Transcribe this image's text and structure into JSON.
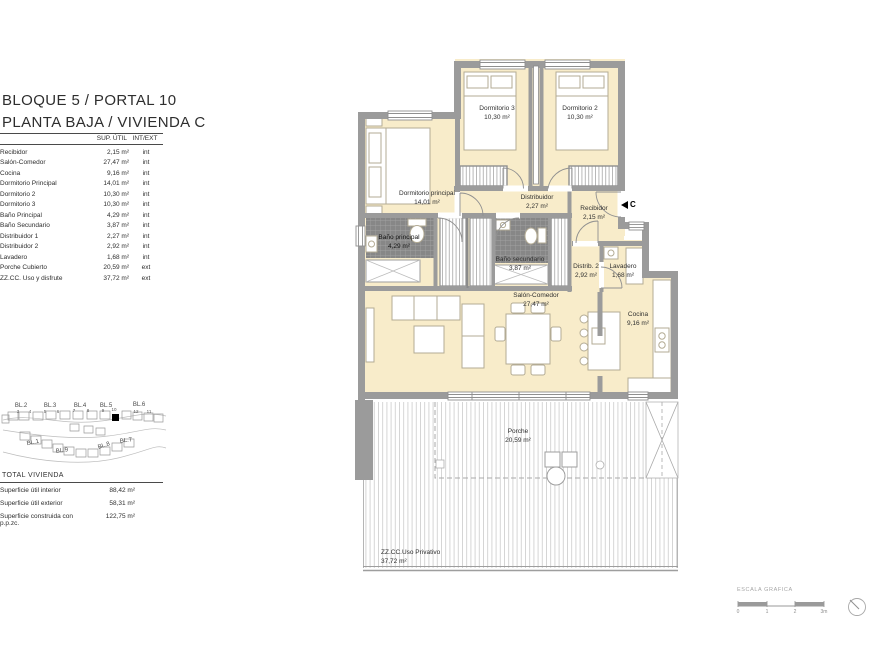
{
  "header": {
    "line1": "BLOQUE 5 / PORTAL 10",
    "line2": "PLANTA BAJA / VIVIENDA C"
  },
  "area_table": {
    "col_sup": "SUP.  ÚTIL",
    "col_intext": "INT/EXT",
    "rows": [
      {
        "label": "Recibidor",
        "value": "2,15 m²",
        "type": "int"
      },
      {
        "label": "Salón-Comedor",
        "value": "27,47 m²",
        "type": "int"
      },
      {
        "label": "Cocina",
        "value": "9,16 m²",
        "type": "int"
      },
      {
        "label": "Dormitorio Principal",
        "value": "14,01 m²",
        "type": "int"
      },
      {
        "label": "Dormitorio 2",
        "value": "10,30 m²",
        "type": "int"
      },
      {
        "label": "Dormitorio 3",
        "value": "10,30 m²",
        "type": "int"
      },
      {
        "label": "Baño Principal",
        "value": "4,29 m²",
        "type": "int"
      },
      {
        "label": "Baño Secundario",
        "value": "3,87 m²",
        "type": "int"
      },
      {
        "label": "Distribuidor 1",
        "value": "2,27 m²",
        "type": "int"
      },
      {
        "label": "Distribuidor 2",
        "value": "2,92 m²",
        "type": "int"
      },
      {
        "label": "Lavadero",
        "value": "1,68 m²",
        "type": "int"
      },
      {
        "label": "Porche Cubierto",
        "value": "20,59 m²",
        "type": "ext"
      },
      {
        "label": "ZZ.CC. Uso y disfrute",
        "value": "37,72 m²",
        "type": "ext"
      }
    ]
  },
  "totals": {
    "title": "TOTAL VIVIENDA",
    "rows": [
      {
        "label": "Superficie útil interior",
        "value": "88,42 m²"
      },
      {
        "label": "Superficie útil exterior",
        "value": "58,31 m²"
      },
      {
        "label": "Superficie construida con p.p.zc.",
        "value": "122,75 m²"
      }
    ]
  },
  "site_plan": {
    "blocks": [
      "BL.2",
      "BL.3",
      "BL.4",
      "BL.5",
      "BL.6",
      "BL.1",
      "BL.9",
      "BL.8",
      "BL.7"
    ],
    "numbers": [
      "3",
      "4",
      "5",
      "6",
      "7",
      "8",
      "9",
      "10",
      "12",
      "11"
    ]
  },
  "plan": {
    "entry_marker": "C",
    "rooms": [
      {
        "name": "Dormitorio 3",
        "area": "10,30 m²"
      },
      {
        "name": "Dormitorio 2",
        "area": "10,30 m²"
      },
      {
        "name": "Dormitorio principal",
        "area": "14,01 m²"
      },
      {
        "name": "Distribuidor",
        "area": "2,27 m²"
      },
      {
        "name": "Recibidor",
        "area": "2,15 m²"
      },
      {
        "name": "Baño principal",
        "area": "4,29 m²"
      },
      {
        "name": "Baño secundario",
        "area": "3,87 m²"
      },
      {
        "name": "Distrib. 2",
        "area": "2,92 m²"
      },
      {
        "name": "Lavadero",
        "area": "1,68 m²"
      },
      {
        "name": "Salón-Comedor",
        "area": "27,47 m²"
      },
      {
        "name": "Cocina",
        "area": "9,16 m²"
      },
      {
        "name": "Porche",
        "area": "20,59 m²"
      },
      {
        "name": "ZZ.CC.Uso Privativo",
        "area": "37,72 m²"
      }
    ]
  },
  "scale_bar": {
    "title": "ESCALA GRAFICA",
    "ticks": [
      "0",
      "1",
      "2",
      "3m"
    ]
  },
  "colors": {
    "room_fill": "#f8ecca",
    "wall": "#9b9b9b",
    "tile": "#878787",
    "deck_line": "#cccccc"
  }
}
